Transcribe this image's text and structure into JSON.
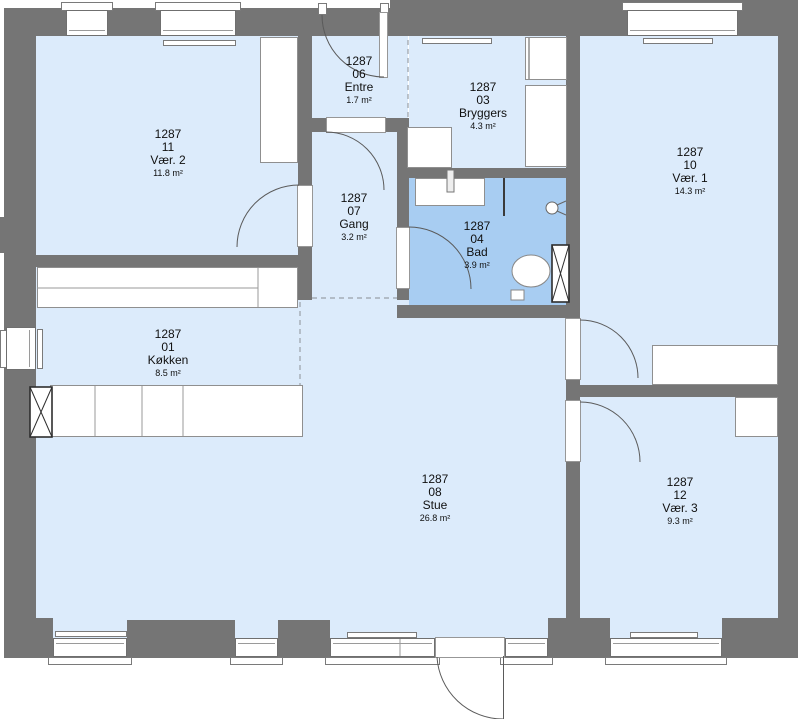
{
  "meta": {
    "title": "Floor plan 1287",
    "width_px": 800,
    "height_px": 719,
    "plan_id": "1287"
  },
  "colors": {
    "wall": "#757575",
    "floor": "#dcebfb",
    "bathroom_floor": "#a8cdf2",
    "outline": "#5a5a5a",
    "background": "#ffffff"
  },
  "fixtures": [
    "sink-icon",
    "faucet-icon",
    "shower-icon",
    "toilet-icon",
    "shaft-x-icon",
    "door-arc-icon",
    "radiator-icon",
    "window-icon",
    "kitchen-counter-icon",
    "wardrobe-icon",
    "washer-icon"
  ],
  "rooms": [
    {
      "project": "1287",
      "number": "11",
      "name": "Vær. 2",
      "area": "11.8 m²"
    },
    {
      "project": "1287",
      "number": "06",
      "name": "Entre",
      "area": "1.7 m²"
    },
    {
      "project": "1287",
      "number": "03",
      "name": "Bryggers",
      "area": "4.3 m²"
    },
    {
      "project": "1287",
      "number": "10",
      "name": "Vær. 1",
      "area": "14.3 m²"
    },
    {
      "project": "1287",
      "number": "07",
      "name": "Gang",
      "area": "3.2 m²"
    },
    {
      "project": "1287",
      "number": "04",
      "name": "Bad",
      "area": "3.9 m²"
    },
    {
      "project": "1287",
      "number": "01",
      "name": "Køkken",
      "area": "8.5 m²"
    },
    {
      "project": "1287",
      "number": "08",
      "name": "Stue",
      "area": "26.8 m²"
    },
    {
      "project": "1287",
      "number": "12",
      "name": "Vær. 3",
      "area": "9.3 m²"
    }
  ]
}
